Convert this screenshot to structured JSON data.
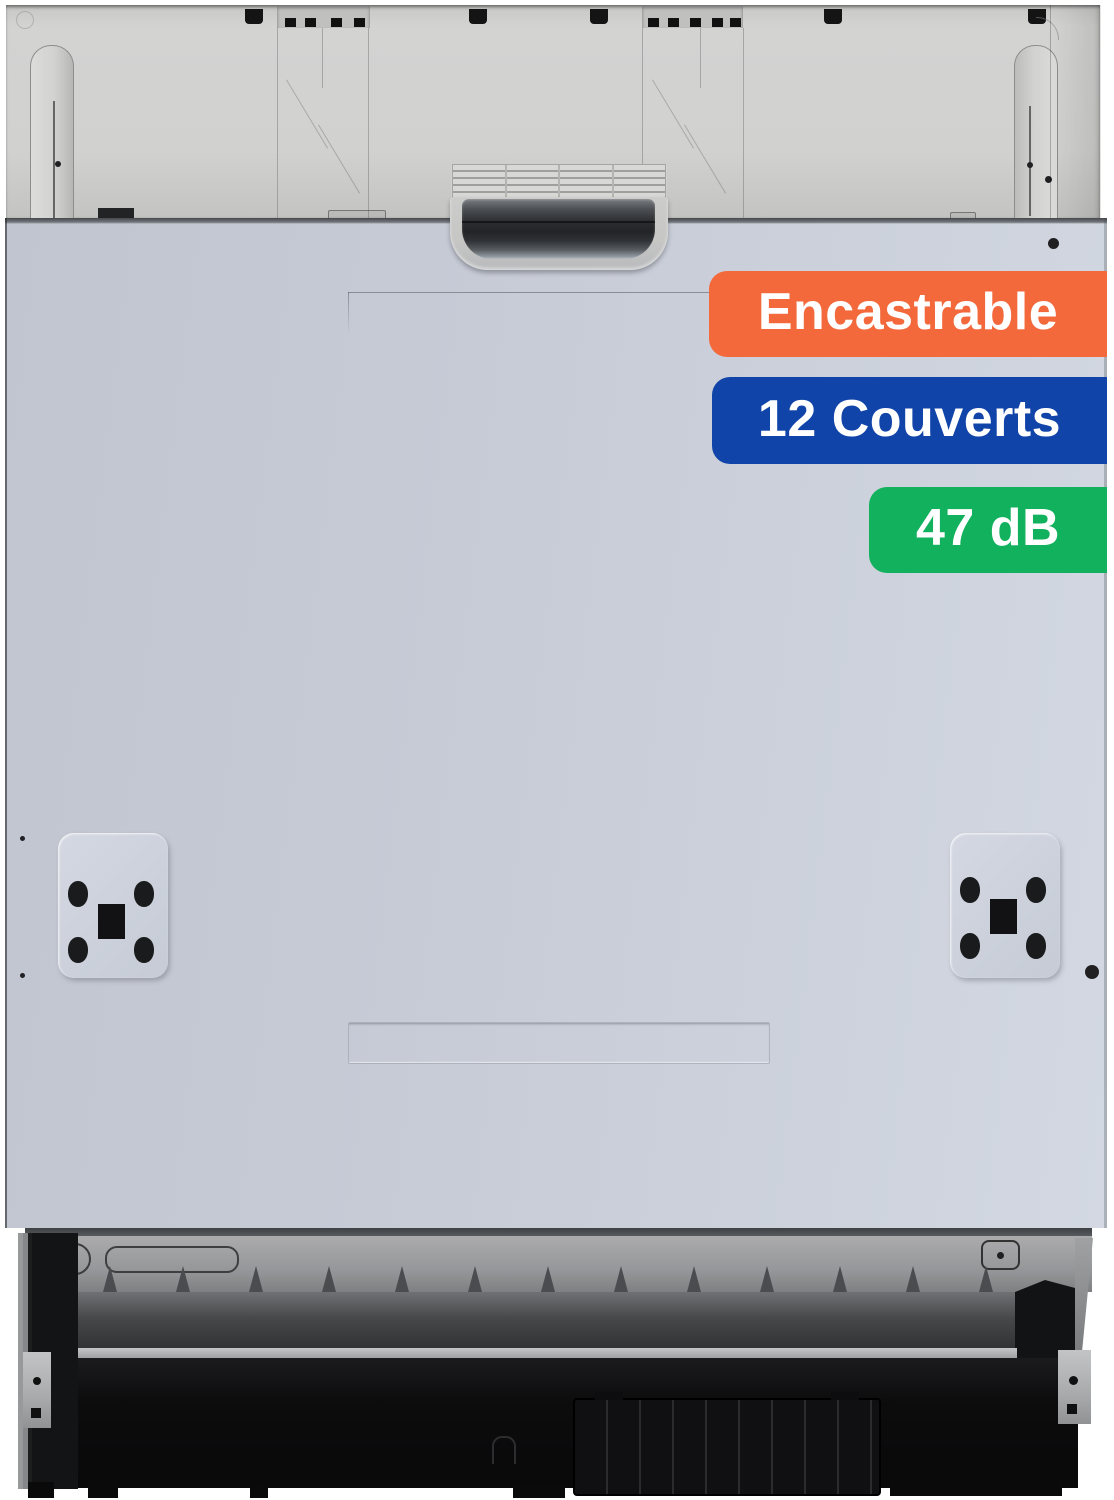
{
  "image": {
    "type": "product-photo",
    "subject": "Lave-vaisselle encastrable (built-in dishwasher), front view with mounting frame, recessed handle and kick plate"
  },
  "badges": [
    {
      "label": "Encastrable",
      "color": "#F3693C"
    },
    {
      "label": "12 Couverts",
      "color": "#1144A9"
    },
    {
      "label": "47 dB",
      "color": "#11B15D"
    }
  ],
  "palette": {
    "background": "#FFFFFF",
    "door_panel": "#C9CDD8",
    "top_frame": "#D1D1D0",
    "handle_dark": "#2B2D30",
    "base_black": "#0C0C0D",
    "badge_text": "#FFFFFF"
  }
}
